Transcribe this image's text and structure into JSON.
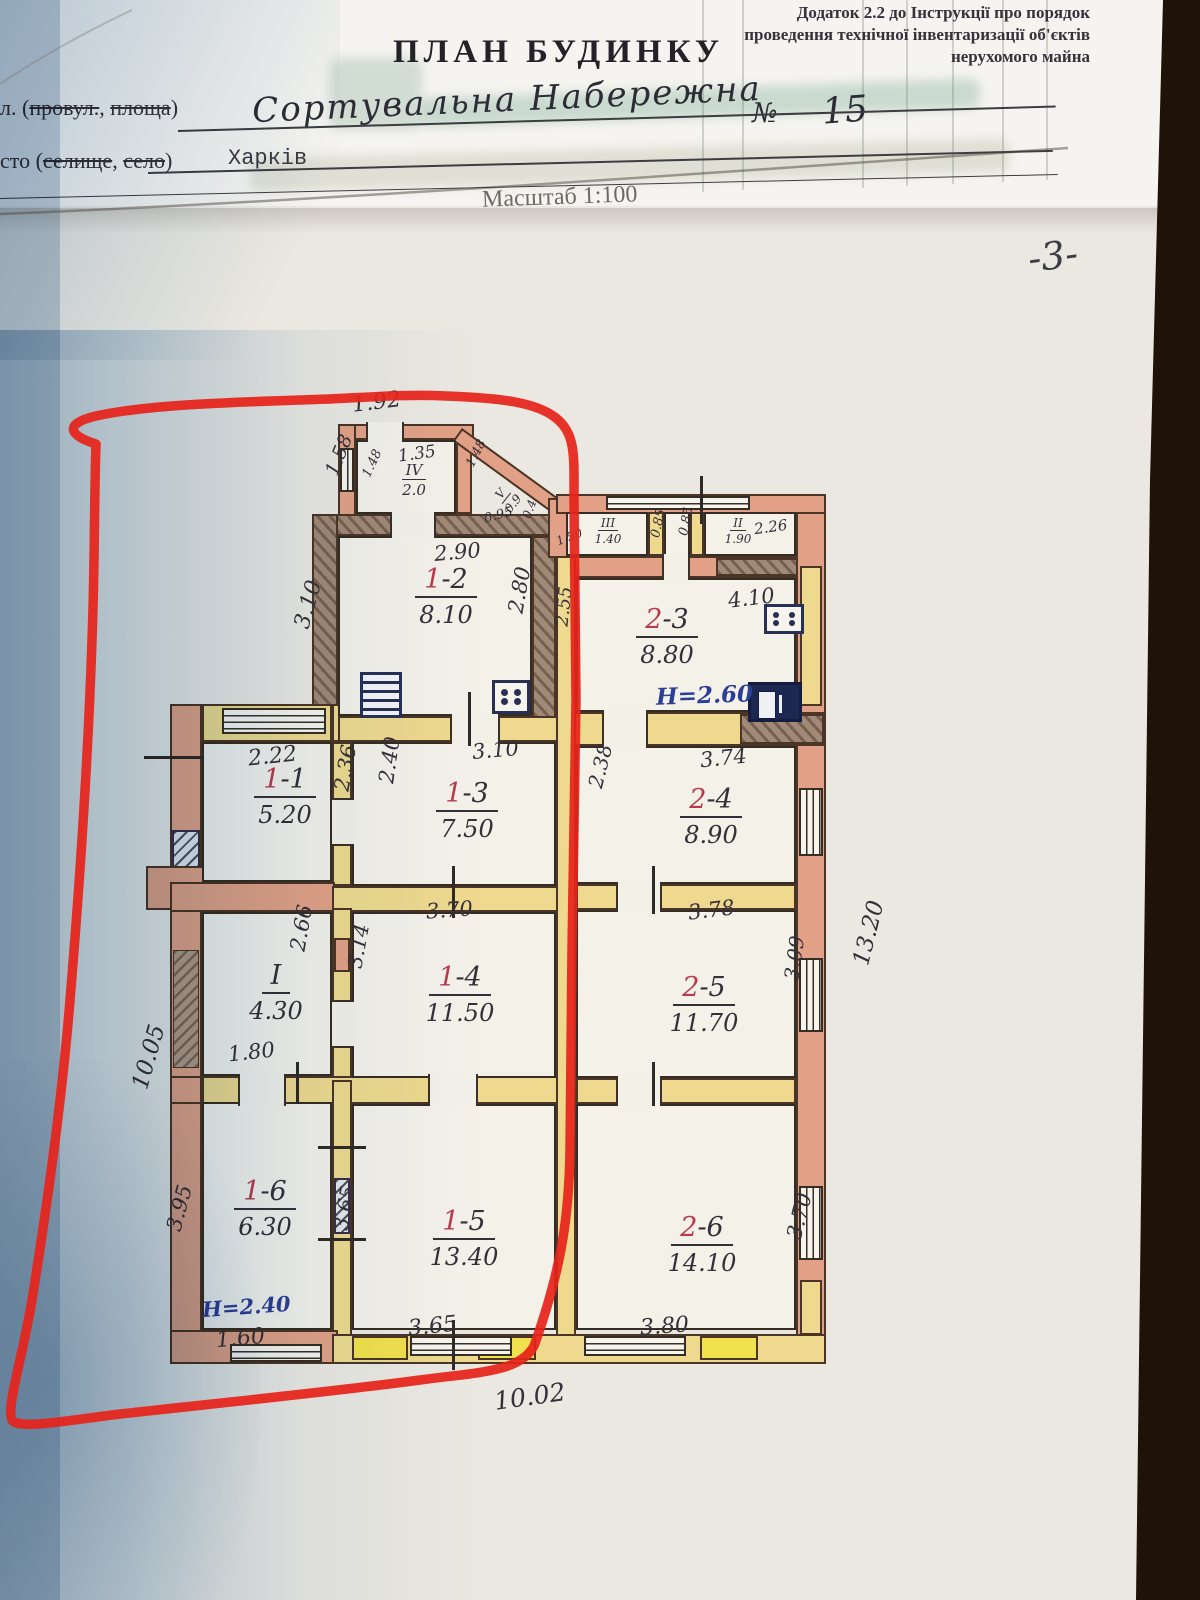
{
  "header": {
    "appendix": [
      "Додаток 2.2 до Інструкції про порядок",
      "проведення технічної інвентаризації об'єктів",
      "нерухомого майна"
    ],
    "title": "ПЛАН БУДИНКУ",
    "street_label_pre": "л. (",
    "street_label_struck1": "провул.",
    "street_label_comma": ", ",
    "street_label_struck2": "площа",
    "street_label_post": ")",
    "street_value": "Сортувальна Набережна",
    "number_sign": "№",
    "house_number": "15",
    "city_label_pre": "сто (",
    "city_label_struck1": "селище",
    "city_label_comma": ", ",
    "city_label_struck2": "село",
    "city_label_post": ")",
    "city_value": "Харків",
    "scale": "Масштаб 1:100",
    "page_number": "-3-"
  },
  "plan": {
    "rooms": {
      "r11": {
        "red": "1",
        "rest": "-1",
        "area": "5.20"
      },
      "r12": {
        "red": "1",
        "rest": "-2",
        "area": "8.10"
      },
      "r13": {
        "red": "1",
        "rest": "-3",
        "area": "7.50"
      },
      "r14": {
        "red": "1",
        "rest": "-4",
        "area": "11.50"
      },
      "r15": {
        "red": "1",
        "rest": "-5",
        "area": "13.40"
      },
      "r16": {
        "red": "1",
        "rest": "-6",
        "area": "6.30"
      },
      "r23": {
        "red": "2",
        "rest": "-3",
        "area": "8.80"
      },
      "r24": {
        "red": "2",
        "rest": "-4",
        "area": "8.90"
      },
      "r25": {
        "red": "2",
        "rest": "-5",
        "area": "11.70"
      },
      "r26": {
        "red": "2",
        "rest": "-6",
        "area": "14.10"
      },
      "ri": {
        "num": "I",
        "area": "4.30"
      },
      "rii": {
        "num": "II",
        "area": "1.90"
      },
      "riii": {
        "num": "III",
        "area": "1.40"
      },
      "riv": {
        "num": "IV",
        "area": "2.0"
      },
      "rv": {
        "num": "V",
        "area": "0.9"
      }
    },
    "heights": {
      "k1": "Н=2.60",
      "k2": "Н=2.40"
    },
    "dims": {
      "porch_top": "1.92",
      "porch_inner": "1.35",
      "porch_left": "1.58",
      "porch_wall_l": "1.48",
      "porch_wall_r": "1.48",
      "v_w": "0.95",
      "v_d": "0.4",
      "r12_top": "2.90",
      "r12_right": "2.80",
      "r12_left": "3.10",
      "r23_left": "2.55",
      "r23_top": "4.10",
      "riii_l": "1.50",
      "c085a": "0.85",
      "c085b": "0.85",
      "rii_top": "2.26",
      "r11_top": "2.22",
      "r11_right": "2.36",
      "r13_left": "2.40",
      "r13_top": "3.10",
      "r24_top": "3.74",
      "r24_left": "2.38",
      "ri_right": "2.66",
      "ri_bottom": "1.80",
      "r14_top": "3.70",
      "r14_left": "3.14",
      "r25_top": "3.78",
      "r25_right": "3.09",
      "right_total": "13.20",
      "r16_left": "3.95",
      "r16_bottom": "1.60",
      "mid_left": "3.65",
      "r15_bottom": "3.65",
      "r26_bottom": "3.80",
      "r26_right": "3.70",
      "bottom_total": "10.02",
      "left_total": "10.05"
    }
  }
}
